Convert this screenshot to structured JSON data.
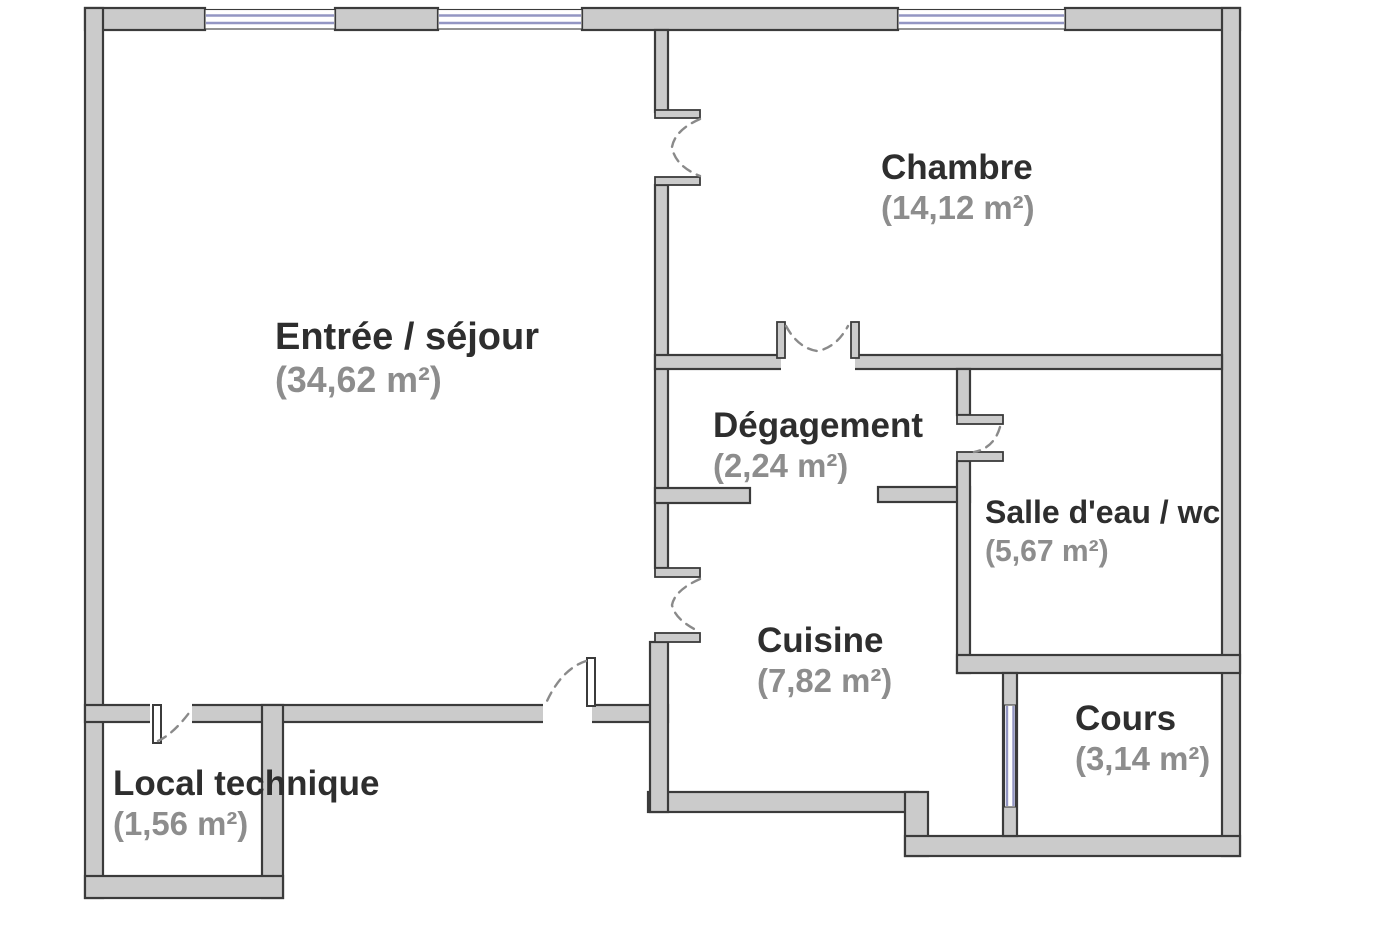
{
  "plan": {
    "type": "apartment-floor-plan",
    "units": "m²"
  },
  "colors": {
    "wall_fill": "#cbcbcb",
    "wall_outline": "#3b3b3b",
    "window_glass": "#9396c3",
    "door_arc": "#8a8a8a",
    "name_color": "#2e2e2e",
    "area_color": "#8d8d8d"
  },
  "rooms": {
    "entree_sejour": {
      "name": "Entrée / séjour",
      "area": "(34,62 m²)"
    },
    "chambre": {
      "name": "Chambre",
      "area": "(14,12 m²)"
    },
    "degagement": {
      "name": "Dégagement",
      "area": "(2,24 m²)"
    },
    "salle_deau_wc": {
      "name": "Salle d'eau / wc",
      "area": "(5,67 m²)"
    },
    "cuisine": {
      "name": "Cuisine",
      "area": "(7,82 m²)"
    },
    "cours": {
      "name": "Cours",
      "area": "(3,14 m²)"
    },
    "local_technique": {
      "name": "Local technique",
      "area": "(1,56 m²)"
    }
  }
}
